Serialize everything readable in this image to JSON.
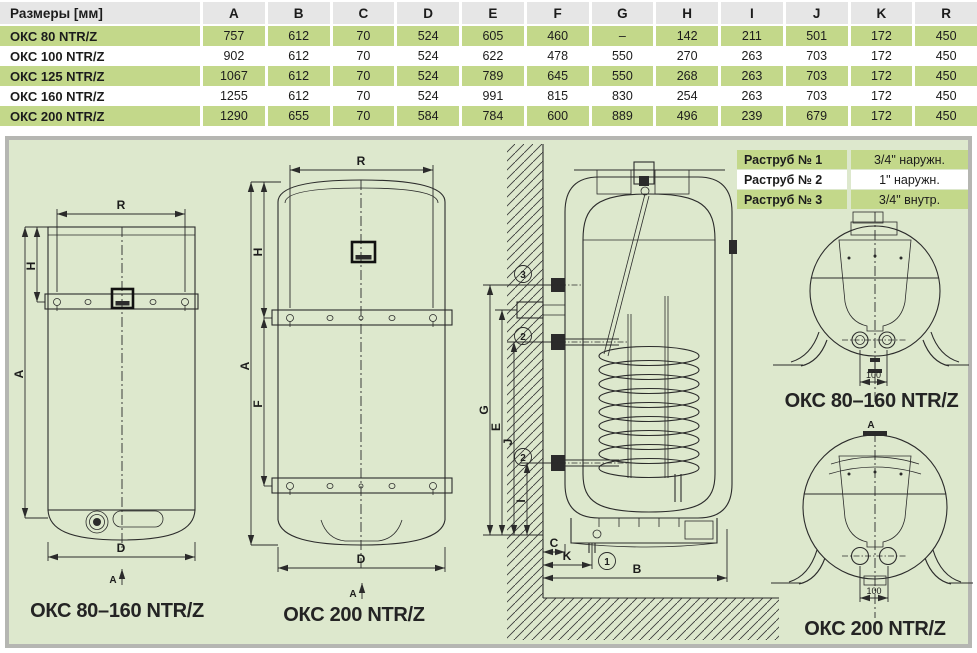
{
  "table": {
    "headers": [
      "Размеры [мм]",
      "A",
      "B",
      "C",
      "D",
      "E",
      "F",
      "G",
      "H",
      "I",
      "J",
      "K",
      "R"
    ],
    "rows": [
      {
        "model": "ОКС 80 NTR/Z",
        "values": [
          "757",
          "612",
          "70",
          "524",
          "605",
          "460",
          "–",
          "142",
          "211",
          "501",
          "172",
          "450"
        ]
      },
      {
        "model": "ОКС 100 NTR/Z",
        "values": [
          "902",
          "612",
          "70",
          "524",
          "622",
          "478",
          "550",
          "270",
          "263",
          "703",
          "172",
          "450"
        ]
      },
      {
        "model": "ОКС 125 NTR/Z",
        "values": [
          "1067",
          "612",
          "70",
          "524",
          "789",
          "645",
          "550",
          "268",
          "263",
          "703",
          "172",
          "450"
        ]
      },
      {
        "model": "ОКС 160 NTR/Z",
        "values": [
          "1255",
          "612",
          "70",
          "524",
          "991",
          "815",
          "830",
          "254",
          "263",
          "703",
          "172",
          "450"
        ]
      },
      {
        "model": "ОКС 200 NTR/Z",
        "values": [
          "1290",
          "655",
          "70",
          "584",
          "784",
          "600",
          "889",
          "496",
          "239",
          "679",
          "172",
          "450"
        ]
      }
    ]
  },
  "fittings": {
    "rows": [
      {
        "label": "Раструб № 1",
        "value": "3/4\" наружн."
      },
      {
        "label": "Раструб № 2",
        "value": "1\" наружн."
      },
      {
        "label": "Раструб № 3",
        "value": "3/4\" внутр."
      }
    ]
  },
  "drawings": {
    "front_small": {
      "caption": "ОКС 80–160 NTR/Z",
      "dim_top": "R",
      "dim_left_full": "A",
      "dim_left_short": "H",
      "dim_bottom": "D",
      "view_marker": "A"
    },
    "front_200": {
      "caption": "ОКС 200 NTR/Z",
      "dim_top": "R",
      "dim_left_full": "A",
      "dim_left_short": "H",
      "dim_left_mid": "F",
      "dim_bottom": "D",
      "view_marker": "A"
    },
    "section": {
      "dim_g": "G",
      "dim_e": "E",
      "dim_j": "J",
      "dim_i": "I",
      "dim_c": "C",
      "dim_k": "K",
      "dim_b": "B",
      "callout_1": "1",
      "callout_2": "2",
      "callout_3": "3"
    },
    "bottom_small": {
      "caption": "ОКС 80–160 NTR/Z",
      "dim_spacing": "100"
    },
    "bottom_200": {
      "caption": "ОКС 200 NTR/Z",
      "dim_spacing": "100",
      "view_marker": "A"
    }
  },
  "colors": {
    "row_green": "#c3d88a",
    "header_gray": "#e6e6e6",
    "panel_bg": "#dde8cd",
    "panel_border": "#b5b6b2",
    "line": "#2b2b2b"
  }
}
